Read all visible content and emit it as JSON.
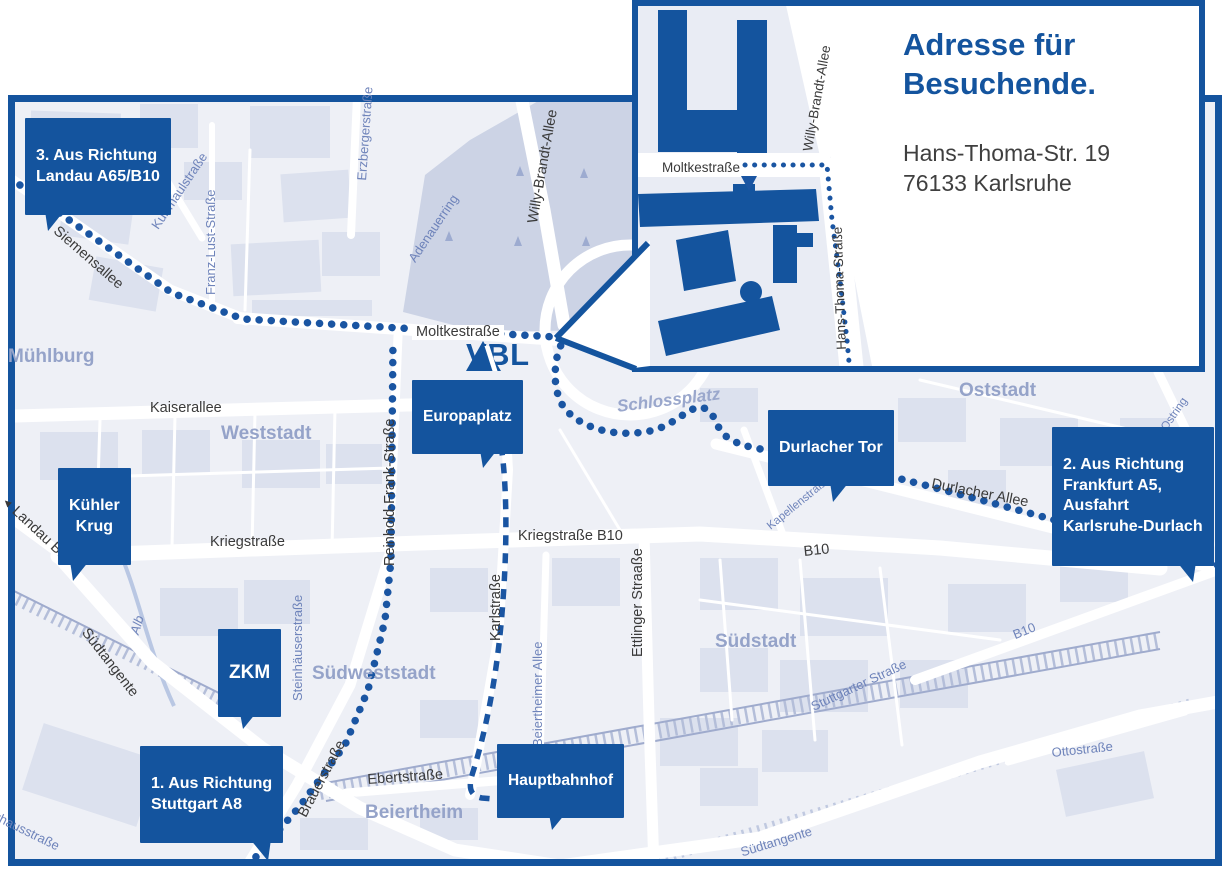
{
  "colors": {
    "brand_blue": "#14549e",
    "route_blue": "#1a55a2",
    "map_bg": "#eef0f6",
    "block_fill": "#dce1ee",
    "park_fill": "#ccd3e5",
    "district_label": "#95a3c9",
    "street_label_dark": "#3a3a3a",
    "street_label_blue": "#6e83ba"
  },
  "logo": {
    "text": "VBL"
  },
  "icons": {
    "landau_arrow": "◄"
  },
  "inset": {
    "title": "Adresse für\nBesuchende.",
    "address": "Hans-Thoma-Str. 19\n76133 Karlsruhe",
    "streets": {
      "moltkestrasse": "Moltkestraße",
      "willy_brandt_allee": "Willy-Brandt-Allee",
      "hans_thoma_strasse": "Hans-Thoma-Straße"
    }
  },
  "callouts": {
    "landau": "3. Aus Richtung\nLandau A65/B10",
    "frankfurt": "2. Aus Richtung\nFrankfurt A5,\nAusfahrt\nKarlsruhe-Durlach",
    "stuttgart": "1. Aus Richtung\nStuttgart A8",
    "kuehler_krug": "Kühler\nKrug",
    "zkm": "ZKM",
    "europaplatz": "Europaplatz",
    "durlacher_tor": "Durlacher Tor",
    "hauptbahnhof": "Hauptbahnhof"
  },
  "districts": {
    "muehlburg": "Mühlburg",
    "weststadt": "Weststadt",
    "oststadt": "Oststadt",
    "suedstadt": "Südstadt",
    "suedweststadt": "Südweststadt",
    "beiertheim": "Beiertheim",
    "schlossplatz": "Schlossplatz"
  },
  "streets": {
    "siemensallee": "Siemensallee",
    "moltkestrasse": "Moltkestraße",
    "kaiserallee": "Kaiserallee",
    "kriegstrasse": "Kriegstraße",
    "kriegstrasse_b10": "Kriegstraße B10",
    "karlstrasse": "Karlstraße",
    "ettlinger_strasse": "Ettlinger Straaße",
    "reinhold_frank_strasse": "Reinhold-Frank-Straße",
    "brauerstrasse": "Brauerstraße",
    "ebertstrasse": "Ebertstraße",
    "suedtangente_west": "Südtangente",
    "suedtangente_sued": "Südtangente",
    "landau_b10": "Landau B10",
    "durlacher_allee": "Durlacher Allee",
    "b10_mitte": "B10",
    "b10_ost": "B10",
    "willy_brandt_allee": "Willy-Brandt-Allee",
    "kussmaulstrasse": "Kußmaulstraße",
    "franz_lust_strasse": "Franz-Lust-Straße",
    "erzbergerstrasse": "Erzbergerstraße",
    "adenauerring": "Adenauerring",
    "steinhaeuserstrasse": "Steinhäuserstraße",
    "beiertheimer_allee": "Beiertheimer Allee",
    "kapellenstrasse": "Kapellenstraße",
    "ostring_1": "Ostring",
    "ostring_2": "Ostring",
    "stuttgarter_strasse": "Stuttgarter Straße",
    "ottostrasse": "Ottostraße",
    "pulverhausstrasse": "Pulverhausstraße",
    "alb": "Alb"
  }
}
